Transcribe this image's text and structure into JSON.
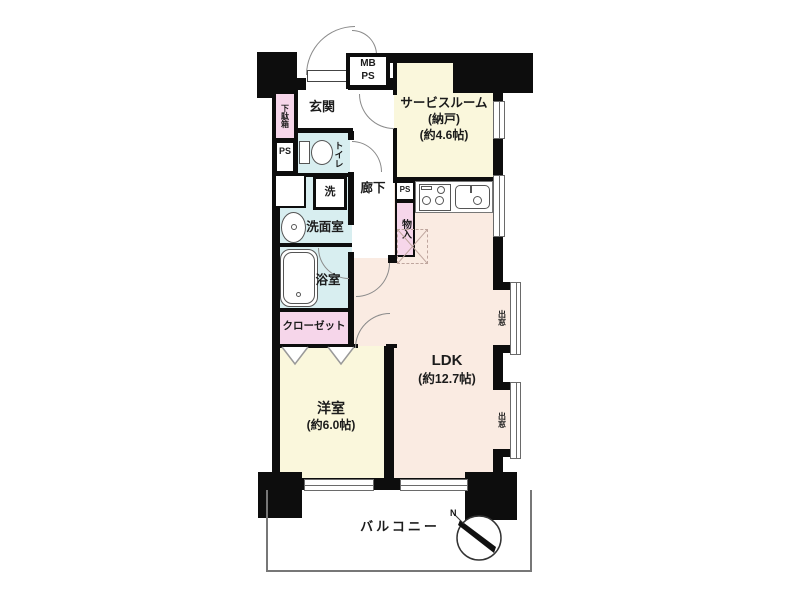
{
  "plan": {
    "rooms": {
      "genkan": {
        "label": "玄関"
      },
      "service_room": {
        "line1": "サービスルーム",
        "line2": "(納戸)",
        "line3": "(約4.6帖)"
      },
      "hallway": {
        "label": "廊下"
      },
      "washroom": {
        "label": "洗面室"
      },
      "bathroom": {
        "label": "浴室"
      },
      "closet": {
        "label": "クローゼット"
      },
      "western_room": {
        "line1": "洋室",
        "line2": "(約6.0帖)"
      },
      "ldk": {
        "line1": "LDK",
        "line2": "(約12.7帖)"
      },
      "balcony": {
        "label": "バルコニー"
      }
    },
    "fixtures": {
      "shoe_cabinet": "下駄箱",
      "ps_left": "PS",
      "toilet": "トイレ",
      "washer": "洗",
      "mb": "MB",
      "ps_top": "PS",
      "ps_kitchen": "PS",
      "storage": "物入",
      "bay_window_1": "出窓",
      "bay_window_2": "出窓",
      "compass_north": "N"
    },
    "colors": {
      "room_yellow": "#faf7dc",
      "room_pink": "#faebe2",
      "room_blue": "#d8eef0",
      "storage_pink": "#f6d6ea",
      "wall": "#0d0d0d"
    }
  }
}
